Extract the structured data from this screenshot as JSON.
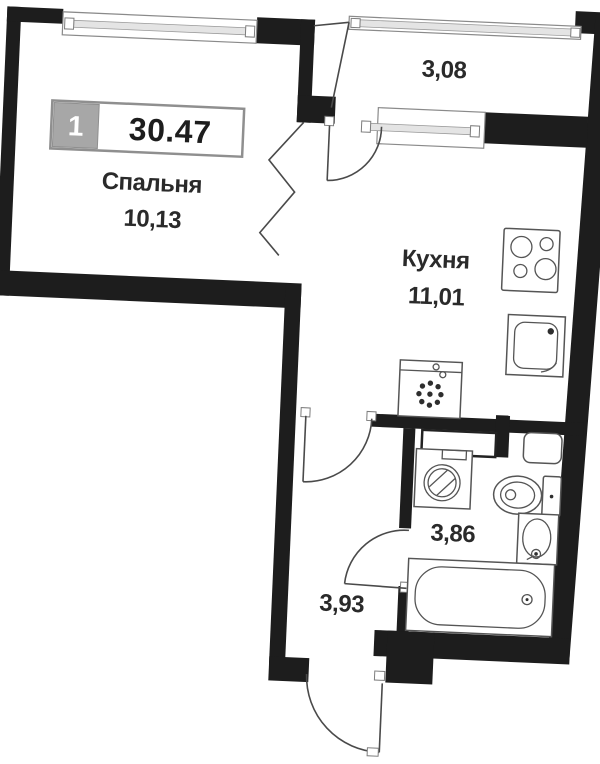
{
  "plan": {
    "unit_badge": {
      "number": "1",
      "total_area": "30.47"
    },
    "rooms": {
      "bedroom": {
        "name": "Спальня",
        "area": "10,13"
      },
      "kitchen": {
        "name": "Кухня",
        "area": "11,01"
      },
      "loggia": {
        "area": "3,08"
      },
      "bathroom": {
        "area": "3,86"
      },
      "hallway": {
        "area": "3,93"
      }
    },
    "icons": [
      "cooktop-icon",
      "kitchen-sink-icon",
      "appliance-icon",
      "vent-duct-icon",
      "water-heater-icon",
      "washing-machine-icon",
      "toilet-icon",
      "washbasin-icon",
      "bathtub-icon",
      "window-icon",
      "door-arc-icon",
      "wall-break-line"
    ],
    "colors": {
      "wall": "#1d1d1d",
      "thin_line": "#4a4a4a",
      "fixture_line": "#555555",
      "glass": "#e4e4e4",
      "badge_number_bg": "#a7a7a7",
      "badge_border": "#8f8f8f",
      "text": "#2a2a2a",
      "background": "#ffffff"
    }
  }
}
